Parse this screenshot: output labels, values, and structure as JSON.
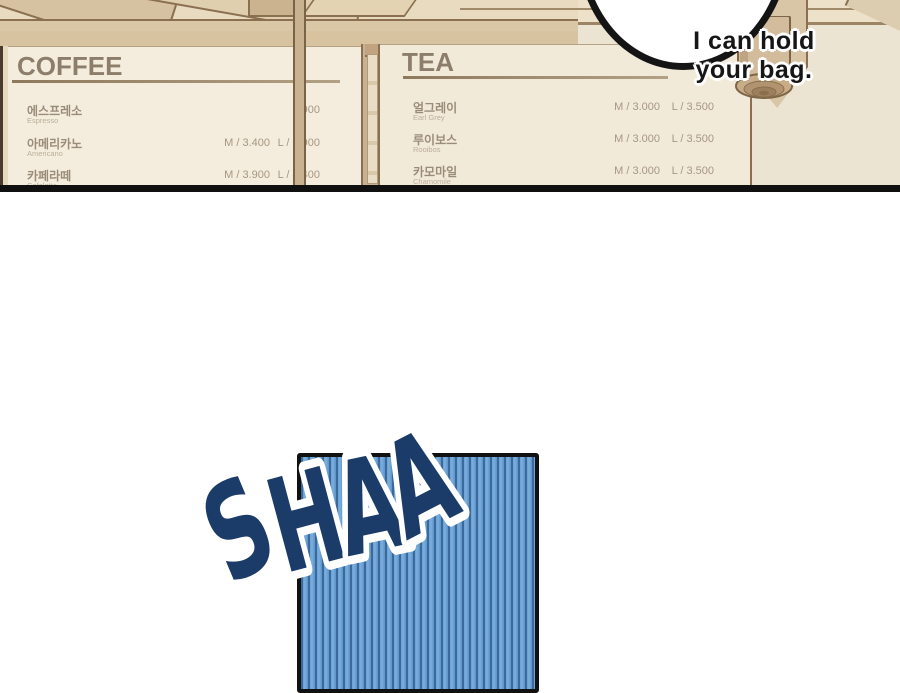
{
  "panel_top": {
    "coffee_menu": {
      "title": "COFFEE",
      "items": [
        {
          "name_ko": "에스프레소",
          "name_en": "Espresso",
          "price_m": "",
          "price_l": "2.900"
        },
        {
          "name_ko": "아메리카노",
          "name_en": "Americano",
          "price_m": "M / 3.400",
          "price_l": "L / 3.900"
        },
        {
          "name_ko": "카페라떼",
          "name_en": "Cafelatte",
          "price_m": "M / 3.900",
          "price_l": "L / 4.400"
        }
      ]
    },
    "tea_menu": {
      "title": "TEA",
      "items": [
        {
          "name_ko": "얼그레이",
          "name_en": "Earl Grey",
          "price_m": "M / 3.000",
          "price_l": "L / 3.500"
        },
        {
          "name_ko": "루이보스",
          "name_en": "Rooibos",
          "price_m": "M / 3.000",
          "price_l": "L / 3.500"
        },
        {
          "name_ko": "카모마일",
          "name_en": "Chamomile",
          "price_m": "M / 3.000",
          "price_l": "L / 3.500"
        }
      ]
    },
    "speech_bubble": {
      "line1": "I can hold",
      "line2": "your bag."
    }
  },
  "panel_bottom": {
    "sfx": "SHAA"
  },
  "colors": {
    "wood_light": "#e8dbc0",
    "wood_mid": "#d6c2a0",
    "wood_outline": "#8a7050",
    "menu_board": "#f3ecdd",
    "menu_text": "#9a8c79",
    "price_text": "#a69782",
    "wall": "#ece4d2",
    "panel_border": "#111111",
    "stripe_light": "#6aa0d3",
    "stripe_dark": "#3c699b",
    "sfx_fill": "#1b3c69",
    "sfx_outline": "#ffffff",
    "bubble_border": "#141414"
  }
}
